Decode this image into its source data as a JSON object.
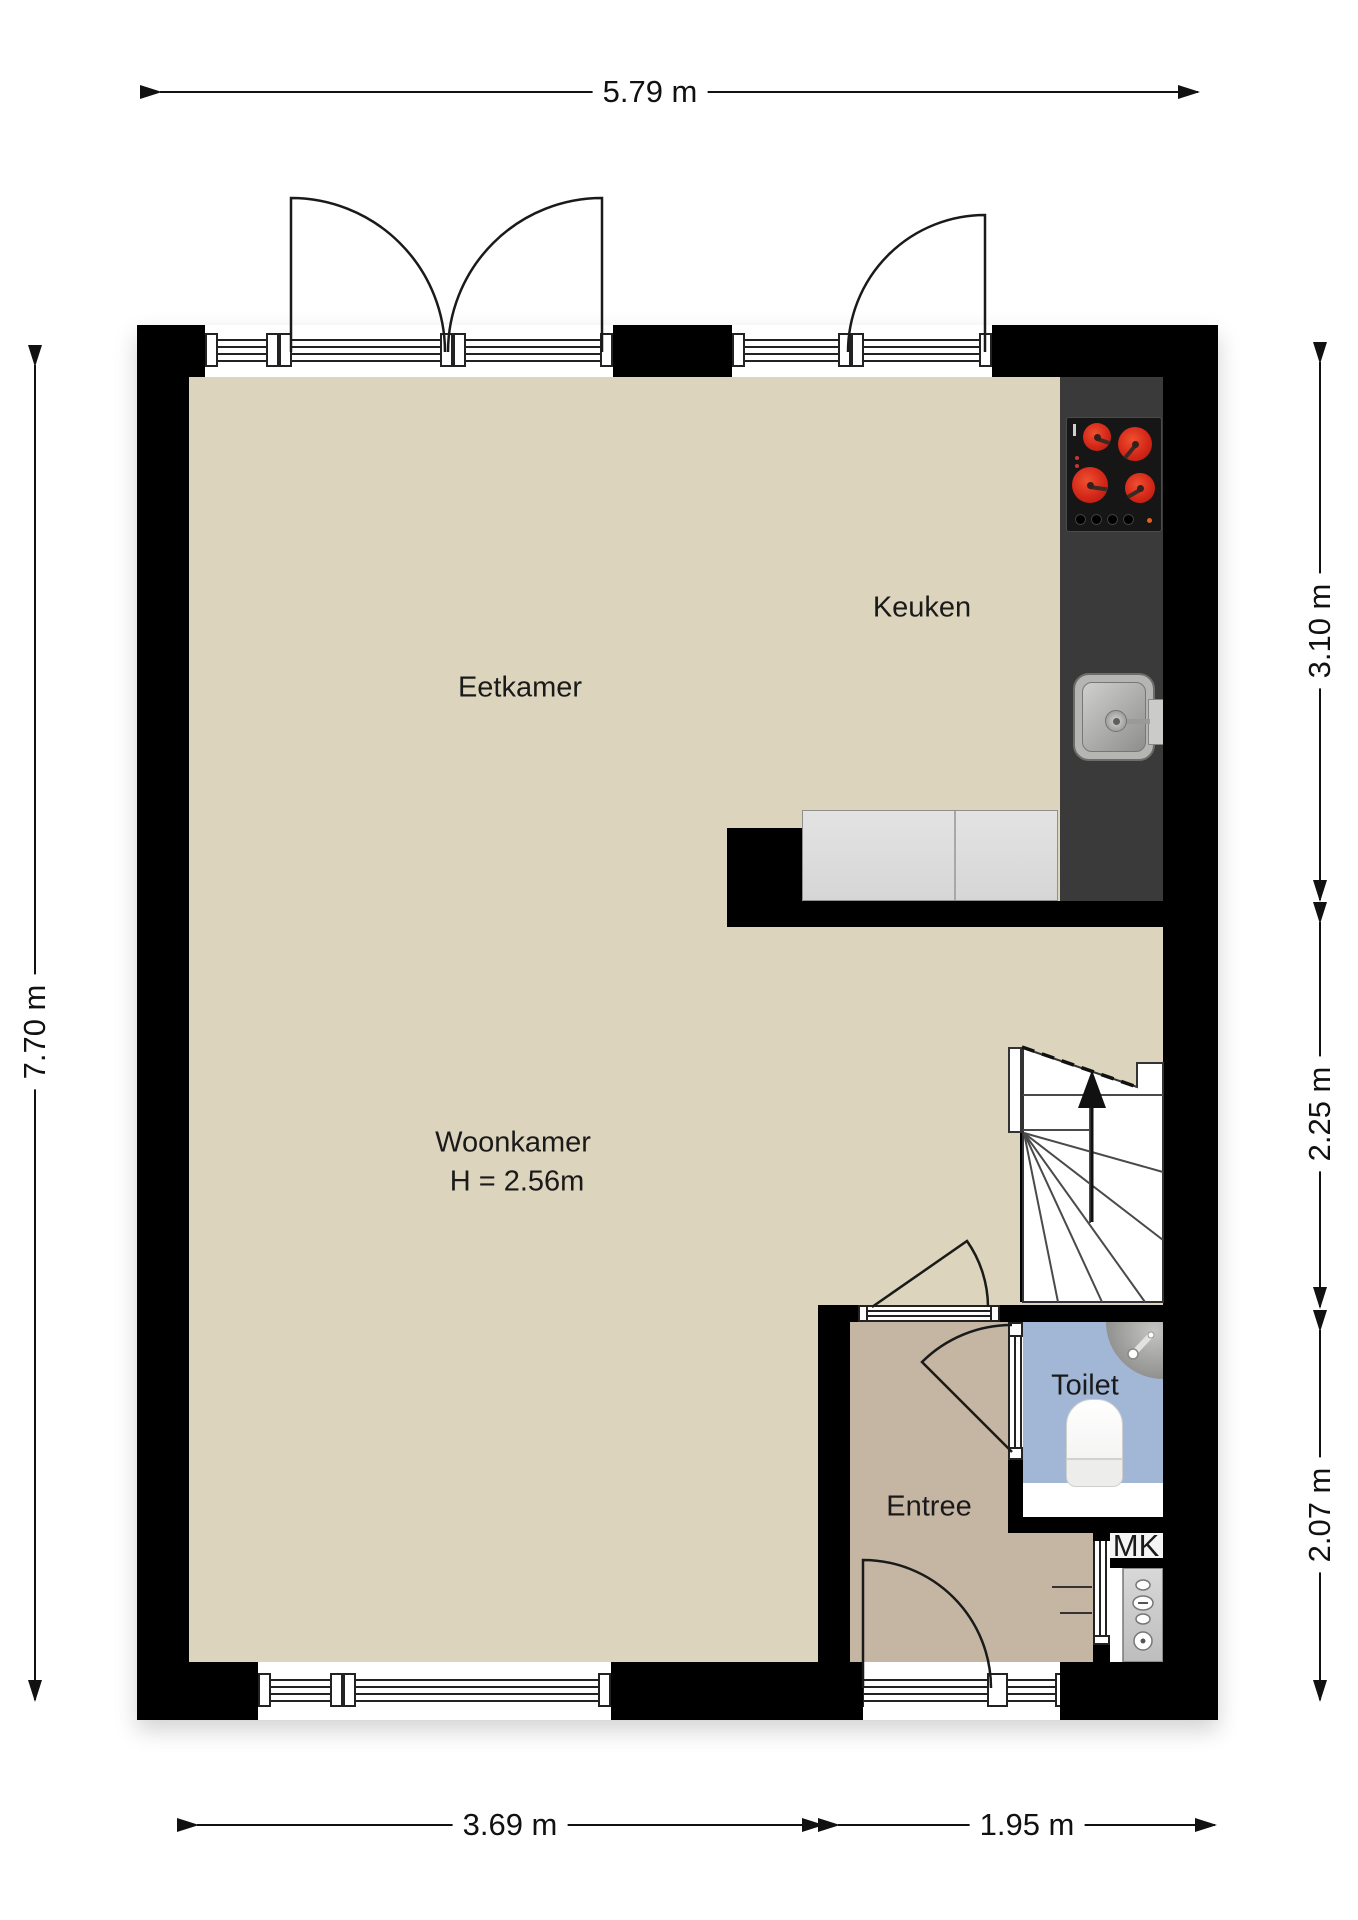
{
  "rooms": {
    "eetkamer": {
      "label": "Eetkamer"
    },
    "keuken": {
      "label": "Keuken"
    },
    "woonkamer": {
      "label": "Woonkamer",
      "height_note": "H = 2.56m"
    },
    "entree": {
      "label": "Entree"
    },
    "toilet": {
      "label": "Toilet"
    },
    "meterkast": {
      "label": "MK"
    }
  },
  "dimensions": {
    "top_width": "5.79 m",
    "left_height": "7.70 m",
    "right_kitchen": "3.10 m",
    "right_stairs": "2.25 m",
    "right_entree": "2.07 m",
    "bottom_livingroom": "3.69 m",
    "bottom_entree": "1.95 m"
  },
  "colors": {
    "wall": "#000000",
    "floor_main": "#dcd4bc",
    "floor_entree": "#c5b6a4",
    "floor_toilet": "#a2b6d6",
    "kitchen_counter": "#3a3a3a",
    "burner_red": "#d42718",
    "cabinet_gray": "#dcdcdc"
  }
}
